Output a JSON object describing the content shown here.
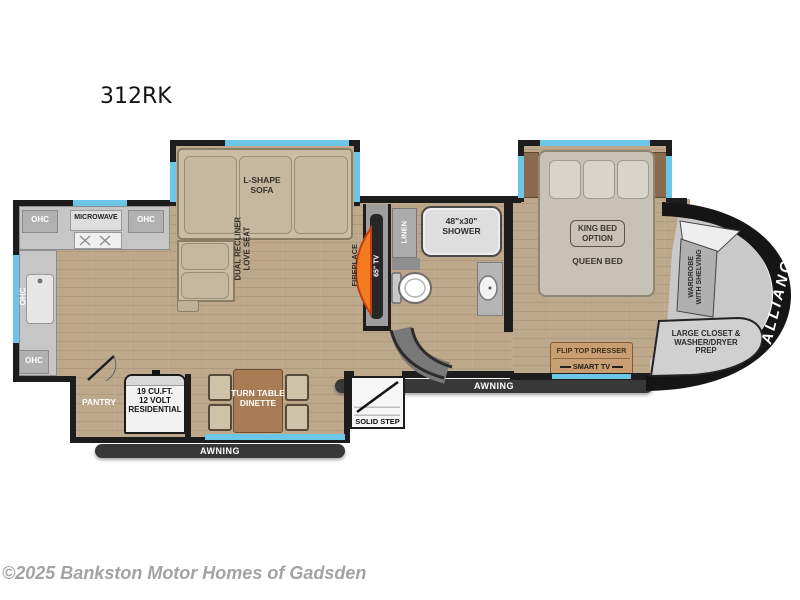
{
  "title": "312RK",
  "watermark": "©2025 Bankston Motor Homes of Gadsden",
  "colors": {
    "wall": "#1d1d1d",
    "wood_floor": "#bda88c",
    "window_blue": "#6cc6e8",
    "counter_gray": "#c6c6c6",
    "sofa_tan": "#cbbda4",
    "bed_taupe": "#c8c2b6",
    "dinette_brown": "#a87c54",
    "fireplace_orange": "#f47b20",
    "awning_dark": "#383838",
    "dresser_tan": "#c89e72",
    "cap_black": "#151515",
    "cap_gray": "#c9c9c9"
  },
  "kitchen": {
    "ohc_top_left": "OHC",
    "microwave": "MICROWAVE",
    "ohc_top_right": "OHC",
    "ohc_side": "OHC",
    "ohc_bottom": "OHC",
    "pantry": "PANTRY",
    "fridge_line1": "19 CU.FT.",
    "fridge_line2": "12 VOLT",
    "fridge_line3": "RESIDENTIAL"
  },
  "living": {
    "sofa_line1": "L-SHAPE",
    "sofa_line2": "SOFA",
    "loveseat_line1": "DUAL RECLINER",
    "loveseat_line2": "LOVE SEAT",
    "fireplace": "FIREPLACE",
    "tv": "65\" TV",
    "dinette_line1": "TURN TABLE",
    "dinette_line2": "DINETTE"
  },
  "bath": {
    "linen": "LINEN",
    "shower_line1": "48\"x30\"",
    "shower_line2": "SHOWER"
  },
  "bedroom": {
    "king_line1": "KING BED",
    "king_line2": "OPTION",
    "queen": "QUEEN BED",
    "flip_top_dresser": "FLIP TOP DRESSER",
    "smart_tv": "SMART TV",
    "wardrobe_line1": "WARDROBE",
    "wardrobe_line2": "WITH SHELVING"
  },
  "front_cap": {
    "closet_line1": "LARGE CLOSET &",
    "closet_line2": "WASHER/DRYER",
    "closet_line3": "PREP",
    "brand": "ALLIANCE"
  },
  "exterior": {
    "awning_left": "AWNING",
    "awning_right": "AWNING",
    "solid_step": "SOLID STEP"
  }
}
